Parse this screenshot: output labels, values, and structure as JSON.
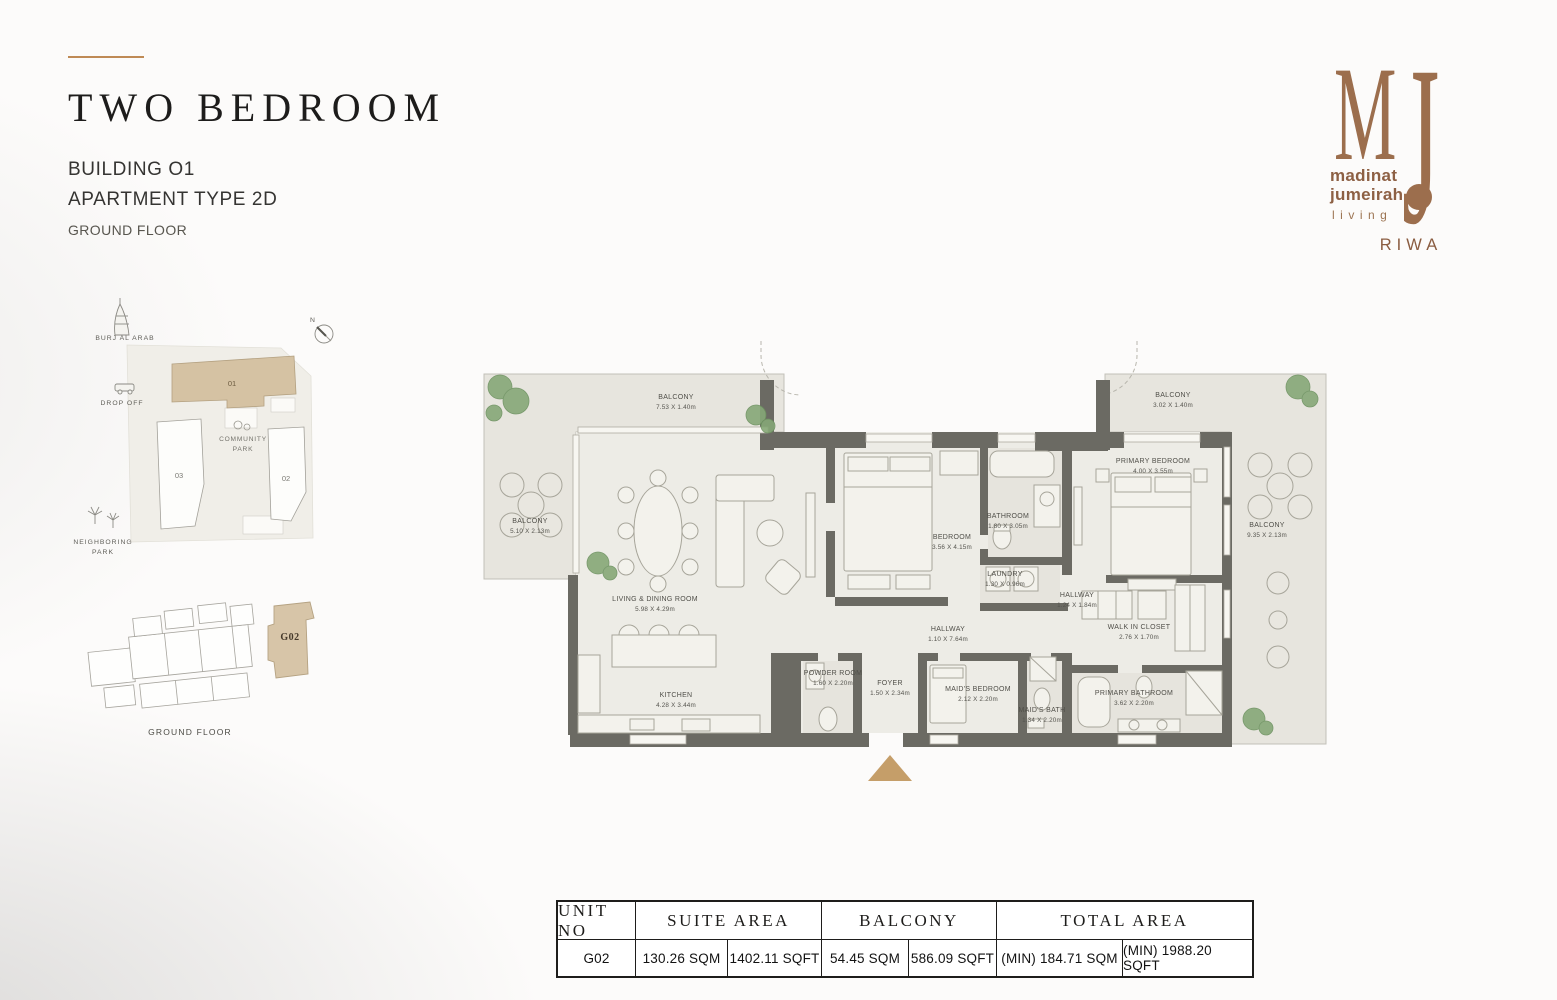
{
  "colors": {
    "accent_tan": "#c59e69",
    "logo_brown": "#9c6e4d",
    "wall_gray": "#6b6a63",
    "highlight_unit": "#d5c2a3"
  },
  "header": {
    "title": "TWO BEDROOM",
    "building": "BUILDING O1",
    "apartment_type": "APARTMENT TYPE 2D",
    "floor": "GROUND FLOOR"
  },
  "logo": {
    "monogram_m": "M",
    "monogram_j": "J",
    "line1": "madinat",
    "line2": "jumeirah",
    "line3": "living",
    "project": "RIWA"
  },
  "site_map": {
    "north": "N",
    "burj": "BURJ AL ARAB",
    "drop_off": "DROP OFF",
    "community_park_1": "COMMUNITY",
    "community_park_2": "PARK",
    "neighboring_park_1": "NEIGHBORING",
    "neighboring_park_2": "PARK",
    "building_01": "01",
    "building_02": "02",
    "building_03": "03"
  },
  "key_plan": {
    "unit": "G02",
    "caption": "GROUND FLOOR"
  },
  "floor_plan": {
    "rooms": [
      {
        "name": "BALCONY",
        "dims": "7.53 X 1.40m"
      },
      {
        "name": "BALCONY",
        "dims": "5.10 X 2.13m"
      },
      {
        "name": "LIVING & DINING ROOM",
        "dims": "5.98 X 4.29m"
      },
      {
        "name": "KITCHEN",
        "dims": "4.28 X 3.44m"
      },
      {
        "name": "BEDROOM",
        "dims": "3.56 X 4.15m"
      },
      {
        "name": "BATHROOM",
        "dims": "1.80 X 3.05m"
      },
      {
        "name": "LAUNDRY",
        "dims": "1.30 X 0.96m"
      },
      {
        "name": "HALLWAY",
        "dims": "1.10 X 7.64m"
      },
      {
        "name": "HALLWAY",
        "dims": "1.24 X 1.84m"
      },
      {
        "name": "POWDER ROOM",
        "dims": "1.60 X 2.20m"
      },
      {
        "name": "FOYER",
        "dims": "1.50 X 2.34m"
      },
      {
        "name": "MAID'S BEDROOM",
        "dims": "2.12 X 2.20m"
      },
      {
        "name": "MAID'S BATH",
        "dims": "1.34 X 2.20m"
      },
      {
        "name": "PRIMARY BEDROOM",
        "dims": "4.00 X 3.55m"
      },
      {
        "name": "WALK IN CLOSET",
        "dims": "2.76 X 1.70m"
      },
      {
        "name": "PRIMARY BATHROOM",
        "dims": "3.62 X 2.20m"
      },
      {
        "name": "BALCONY",
        "dims": "3.02 X 1.40m"
      },
      {
        "name": "BALCONY",
        "dims": "9.35 X 2.13m"
      }
    ]
  },
  "area_table": {
    "h_unit": "UNIT NO",
    "h_suite": "SUITE AREA",
    "h_balcony": "BALCONY",
    "h_total": "TOTAL AREA",
    "unit": "G02",
    "suite_sqm": "130.26 SQM",
    "suite_sqft": "1402.11 SQFT",
    "balcony_sqm": "54.45 SQM",
    "balcony_sqft": "586.09 SQFT",
    "total_sqm": "(MIN) 184.71 SQM",
    "total_sqft": "(MIN) 1988.20 SQFT"
  }
}
